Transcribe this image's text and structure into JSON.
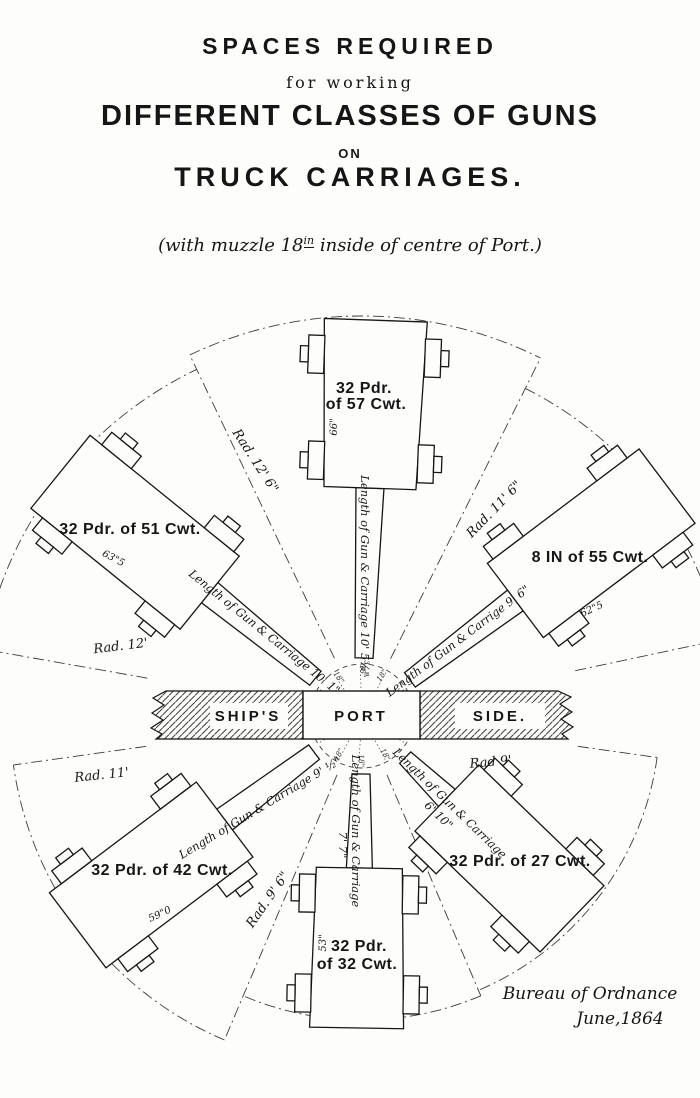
{
  "title": {
    "line1": "SPACES REQUIRED",
    "line2": "for working",
    "line3": "DIFFERENT CLASSES OF GUNS",
    "line4": "ON",
    "line5": "TRUCK CARRIAGES."
  },
  "subtitle": {
    "pre": "(with muzzle 18",
    "sup": "in",
    "post": " inside of centre of Port.)"
  },
  "ship_band": {
    "left": "SHIP'S",
    "port": "PORT",
    "right": "SIDE."
  },
  "muzzle_inset_label": "18\"",
  "guns": [
    {
      "name": "32 Pdr.",
      "name2": "of 57 Cwt.",
      "width_label": "66\"",
      "length_label": "Length of Gun & Carriage 10' 5¾\"",
      "radius_label": "Rad. 12' 6\""
    },
    {
      "name": "32 Pdr. of 51 Cwt.",
      "width_label": "63\"5",
      "length_label": "Length of Gun & Carriage 10' 1\"",
      "radius_label": "Rad. 12'"
    },
    {
      "name": "8 IN of 55 Cwt.",
      "width_label": "62\"5",
      "length_label": "Length of Gun & Carrige 9' 6\"",
      "radius_label": "Rad. 11' 6\""
    },
    {
      "name": "32 Pdr. of 42 Cwt.",
      "width_label": "59\"0",
      "length_label": "Length of Gun & Carriage 9' ½\"",
      "radius_label": "Rad. 11'"
    },
    {
      "name": "32 Pdr.",
      "name2": "of 32 Cwt.",
      "width_label": "53\"",
      "length_label": "Length of Gun & Carriage",
      "length_label2": "7' 7\"",
      "radius_label": "Rad. 9' 6\""
    },
    {
      "name": "32 Pdr. of 27 Cwt.",
      "length_label": "Length of Gun & Carriage",
      "length_label2": "6' 10\"",
      "radius_label": "Rad 9'"
    }
  ],
  "credit": {
    "line1": "Bureau of Ordnance",
    "line2": "June,1864"
  }
}
